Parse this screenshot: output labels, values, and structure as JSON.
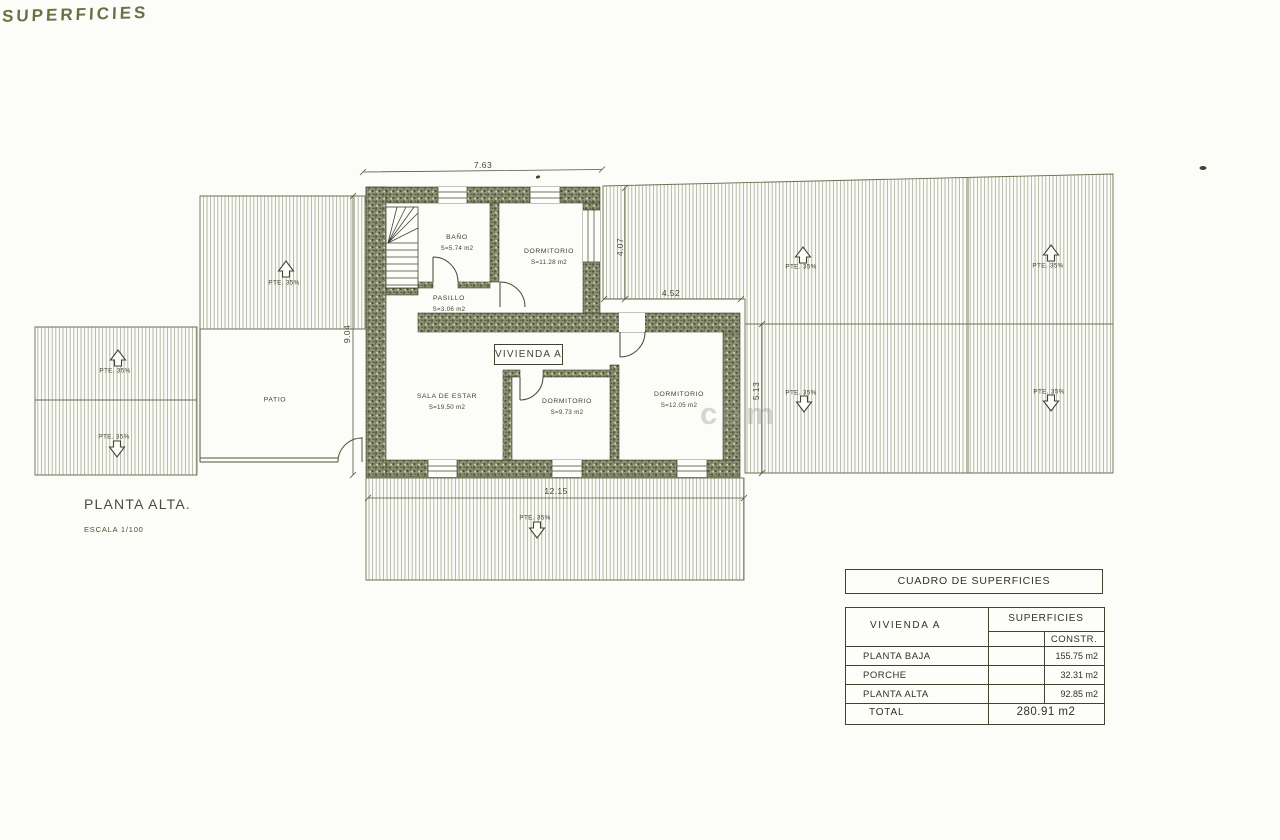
{
  "page": {
    "handwritten_title": "SUPERFICIES",
    "watermark": "com"
  },
  "plan": {
    "title": "PLANTA ALTA.",
    "scale": "ESCALA 1/100",
    "unit_label": "VIVIENDA A",
    "roof_slope_label": "PTE. 35%",
    "rooms": [
      {
        "name": "BAÑO",
        "area": "S=5.74 m2"
      },
      {
        "name": "DORMITORIO",
        "area": "S=11.28 m2"
      },
      {
        "name": "PASILLO",
        "area": "S=3.06 m2"
      },
      {
        "name": "SALA DE ESTAR",
        "area": "S=19.50 m2"
      },
      {
        "name": "DORMITORIO",
        "area": "S=9.73 m2"
      },
      {
        "name": "DORMITORIO",
        "area": "S=12.05 m2"
      },
      {
        "name": "PATIO",
        "area": ""
      }
    ],
    "dimensions": {
      "top_width": "7.63",
      "upper_height": "4.07",
      "right_setback": "4.52",
      "left_height": "9.04",
      "right_height": "5.13",
      "bottom_width": "12.15"
    }
  },
  "table": {
    "title": "CUADRO DE SUPERFICIES",
    "unit": "VIVIENDA A",
    "col_group": "SUPERFICIES",
    "col_constr": "CONSTR.",
    "rows": [
      {
        "label": "PLANTA BAJA",
        "constr": "155.75 m2"
      },
      {
        "label": "PORCHE",
        "constr": "32.31 m2"
      },
      {
        "label": "PLANTA ALTA",
        "constr": "92.85 m2"
      }
    ],
    "total_label": "TOTAL",
    "total_value": "280.91 m2"
  }
}
